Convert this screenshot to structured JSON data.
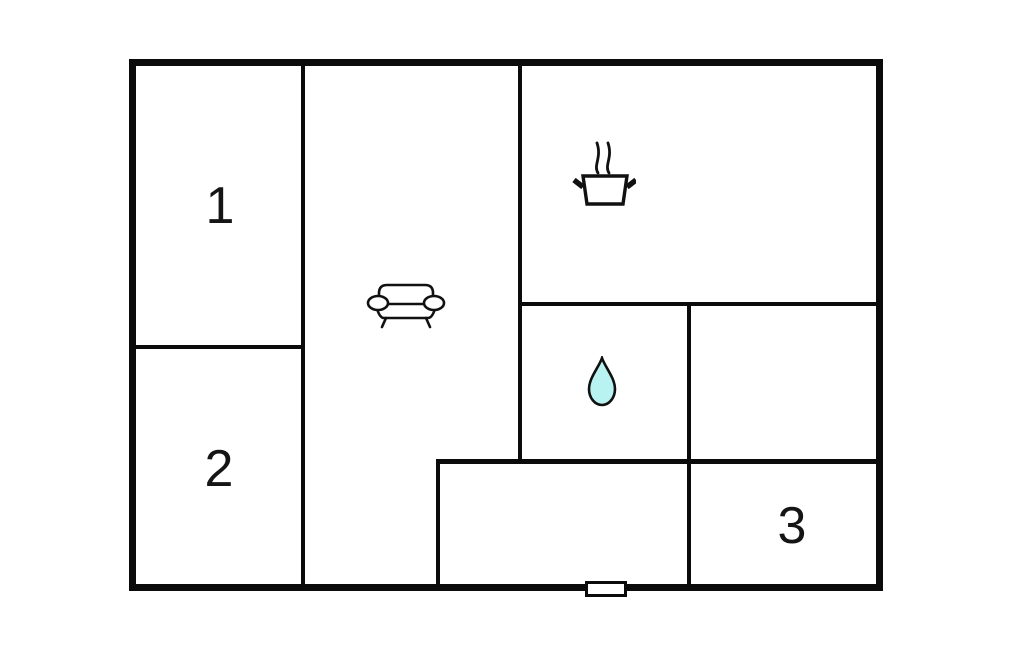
{
  "rooms": [
    {
      "label": "1"
    },
    {
      "label": "2"
    },
    {
      "label": "3"
    }
  ],
  "icons": {
    "living_room": "sofa-icon",
    "kitchen": "cooking-pot-icon",
    "bathroom": "water-drop-icon"
  },
  "colors": {
    "wall": "#0b0b0b",
    "floor": "#ffffff",
    "water_drop_fill": "#b8f3f1",
    "icon_stroke": "#111111"
  }
}
